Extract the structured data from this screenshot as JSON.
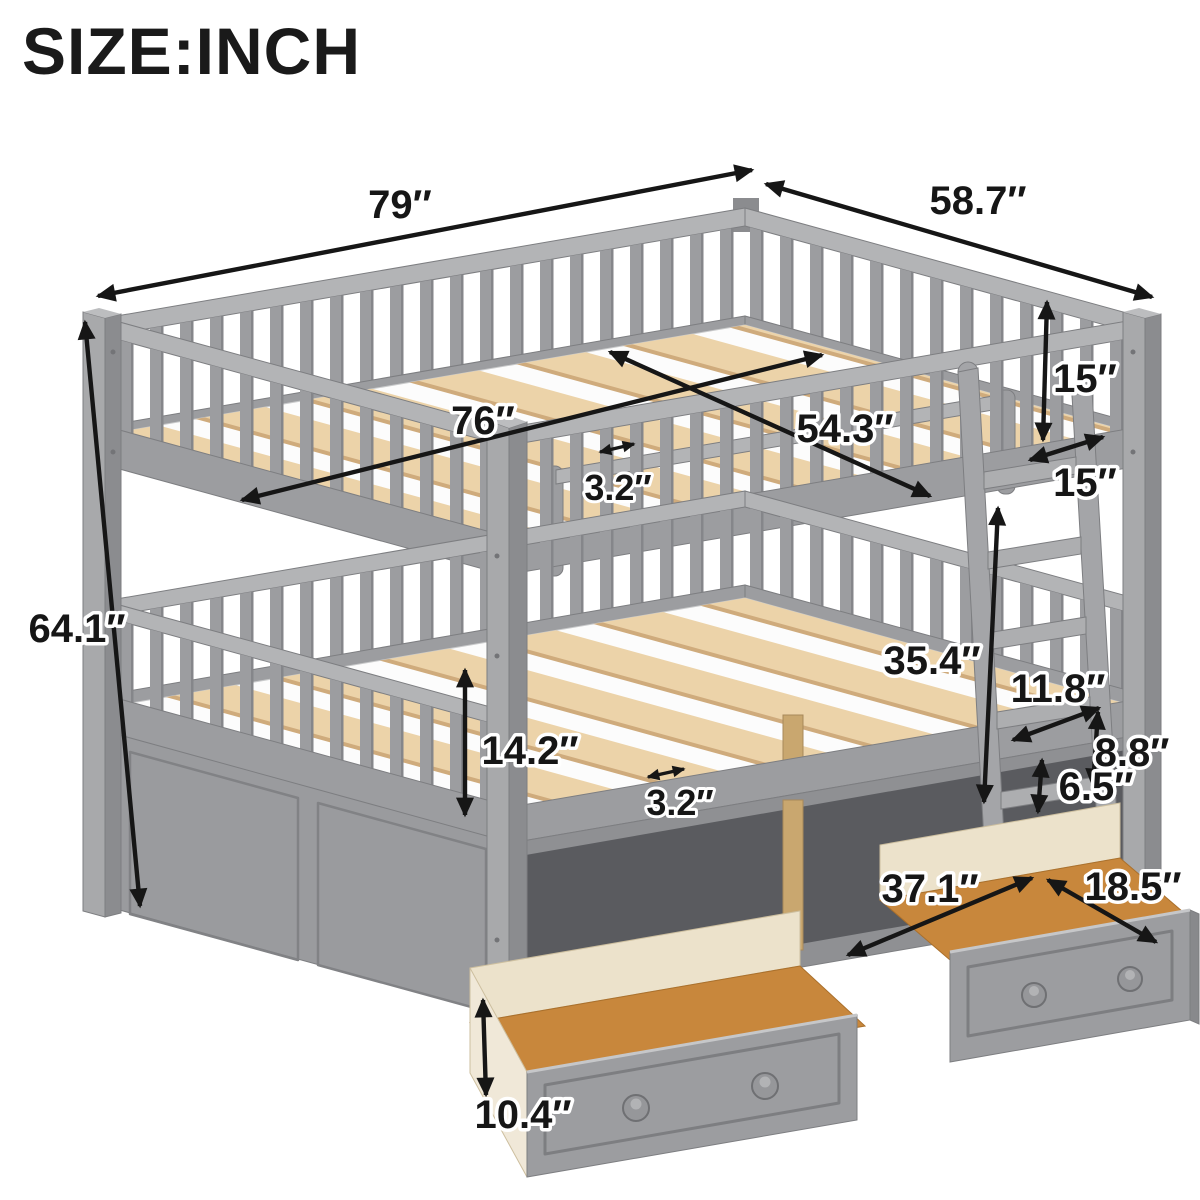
{
  "title": "SIZE:INCH",
  "unit": "inch",
  "figure": "full-over-full bunk bed with guard rails, side ladder and two pull-out storage drawers",
  "colors": {
    "frame": "#9c9da0",
    "frame_light": "#b3b4b6",
    "frame_dark": "#8b8c8f",
    "slat_wood": "#ecd3a9",
    "drawer_interior_wood": "#c8873c",
    "drawer_side_wood": "#f0e8d8",
    "dimension_ink": "#161616",
    "background": "#ffffff"
  },
  "dimensions": {
    "overall_length": "79″",
    "overall_width": "58.7″",
    "overall_height": "64.1″",
    "upper_guardrail_height": "15″",
    "ladder_depth": "15″",
    "upper_slat_length": "76″",
    "upper_slat_width": "54.3″",
    "upper_slat_gap": "3.2″",
    "bunk_clearance": "35.4″",
    "ladder_width": "11.8″",
    "ladder_rung_spacing": "8.8″",
    "lower_guardrail_height": "14.2″",
    "lower_slat_gap": "3.2″",
    "drawer_top_clearance": "6.5″",
    "drawer_length": "37.1″",
    "drawer_depth": "18.5″",
    "drawer_height": "10.4″"
  }
}
